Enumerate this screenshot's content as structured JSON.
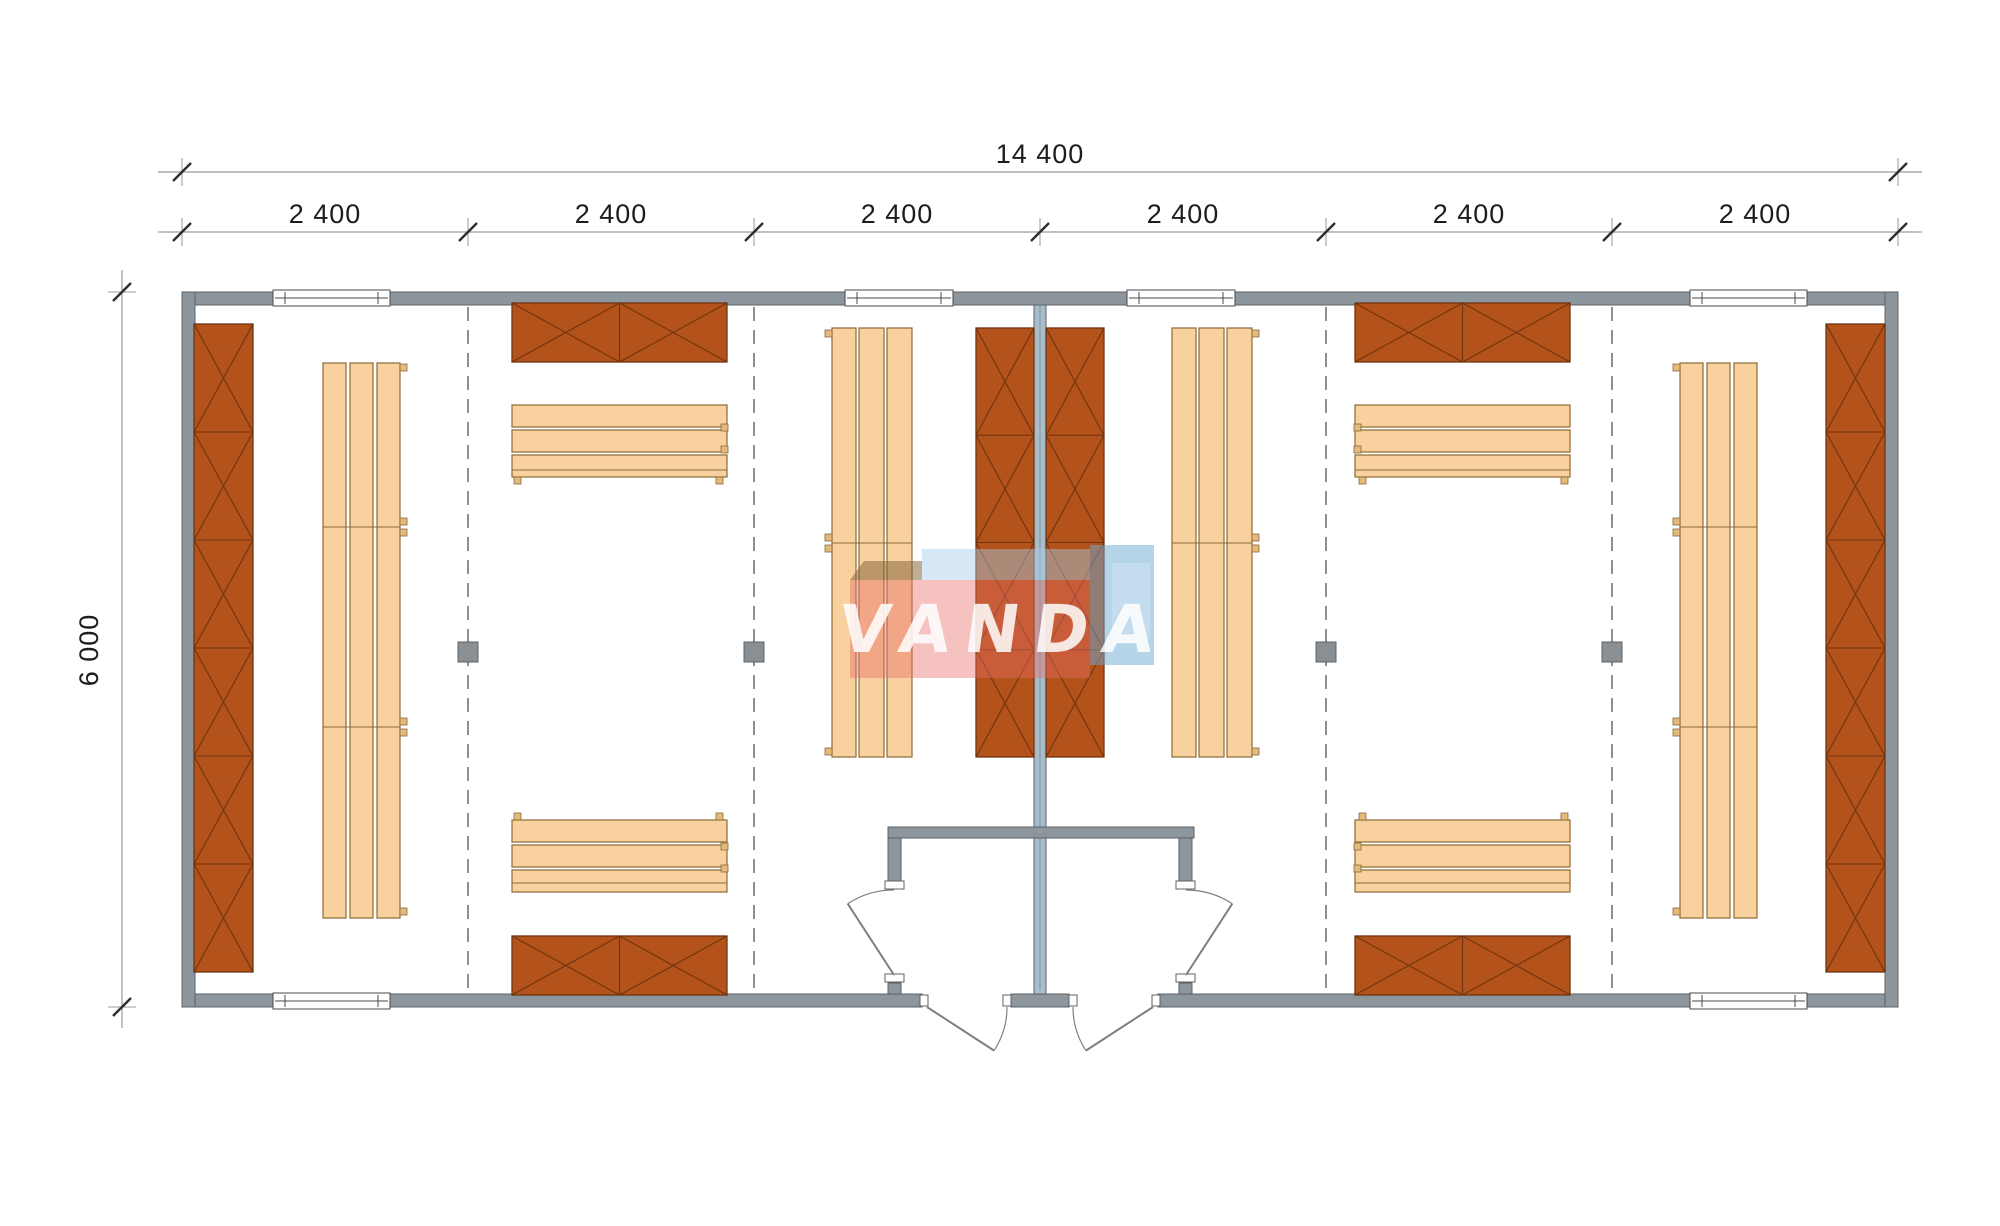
{
  "dimensions": {
    "overall": "14 400",
    "segments": [
      "2 400",
      "2 400",
      "2 400",
      "2 400",
      "2 400",
      "2 400"
    ],
    "height": "6 000"
  },
  "watermark": {
    "text": "VANDA",
    "pink": "#e76e67",
    "blue": "#6caad2"
  },
  "palette": {
    "wall": "#8e969d",
    "partition_wall": "#a9bcc9",
    "cabinet": "#b4521b",
    "bench": "#f8d19e",
    "dimension_line": "#9b9b9b",
    "dimension_text": "#1c1c1c"
  }
}
